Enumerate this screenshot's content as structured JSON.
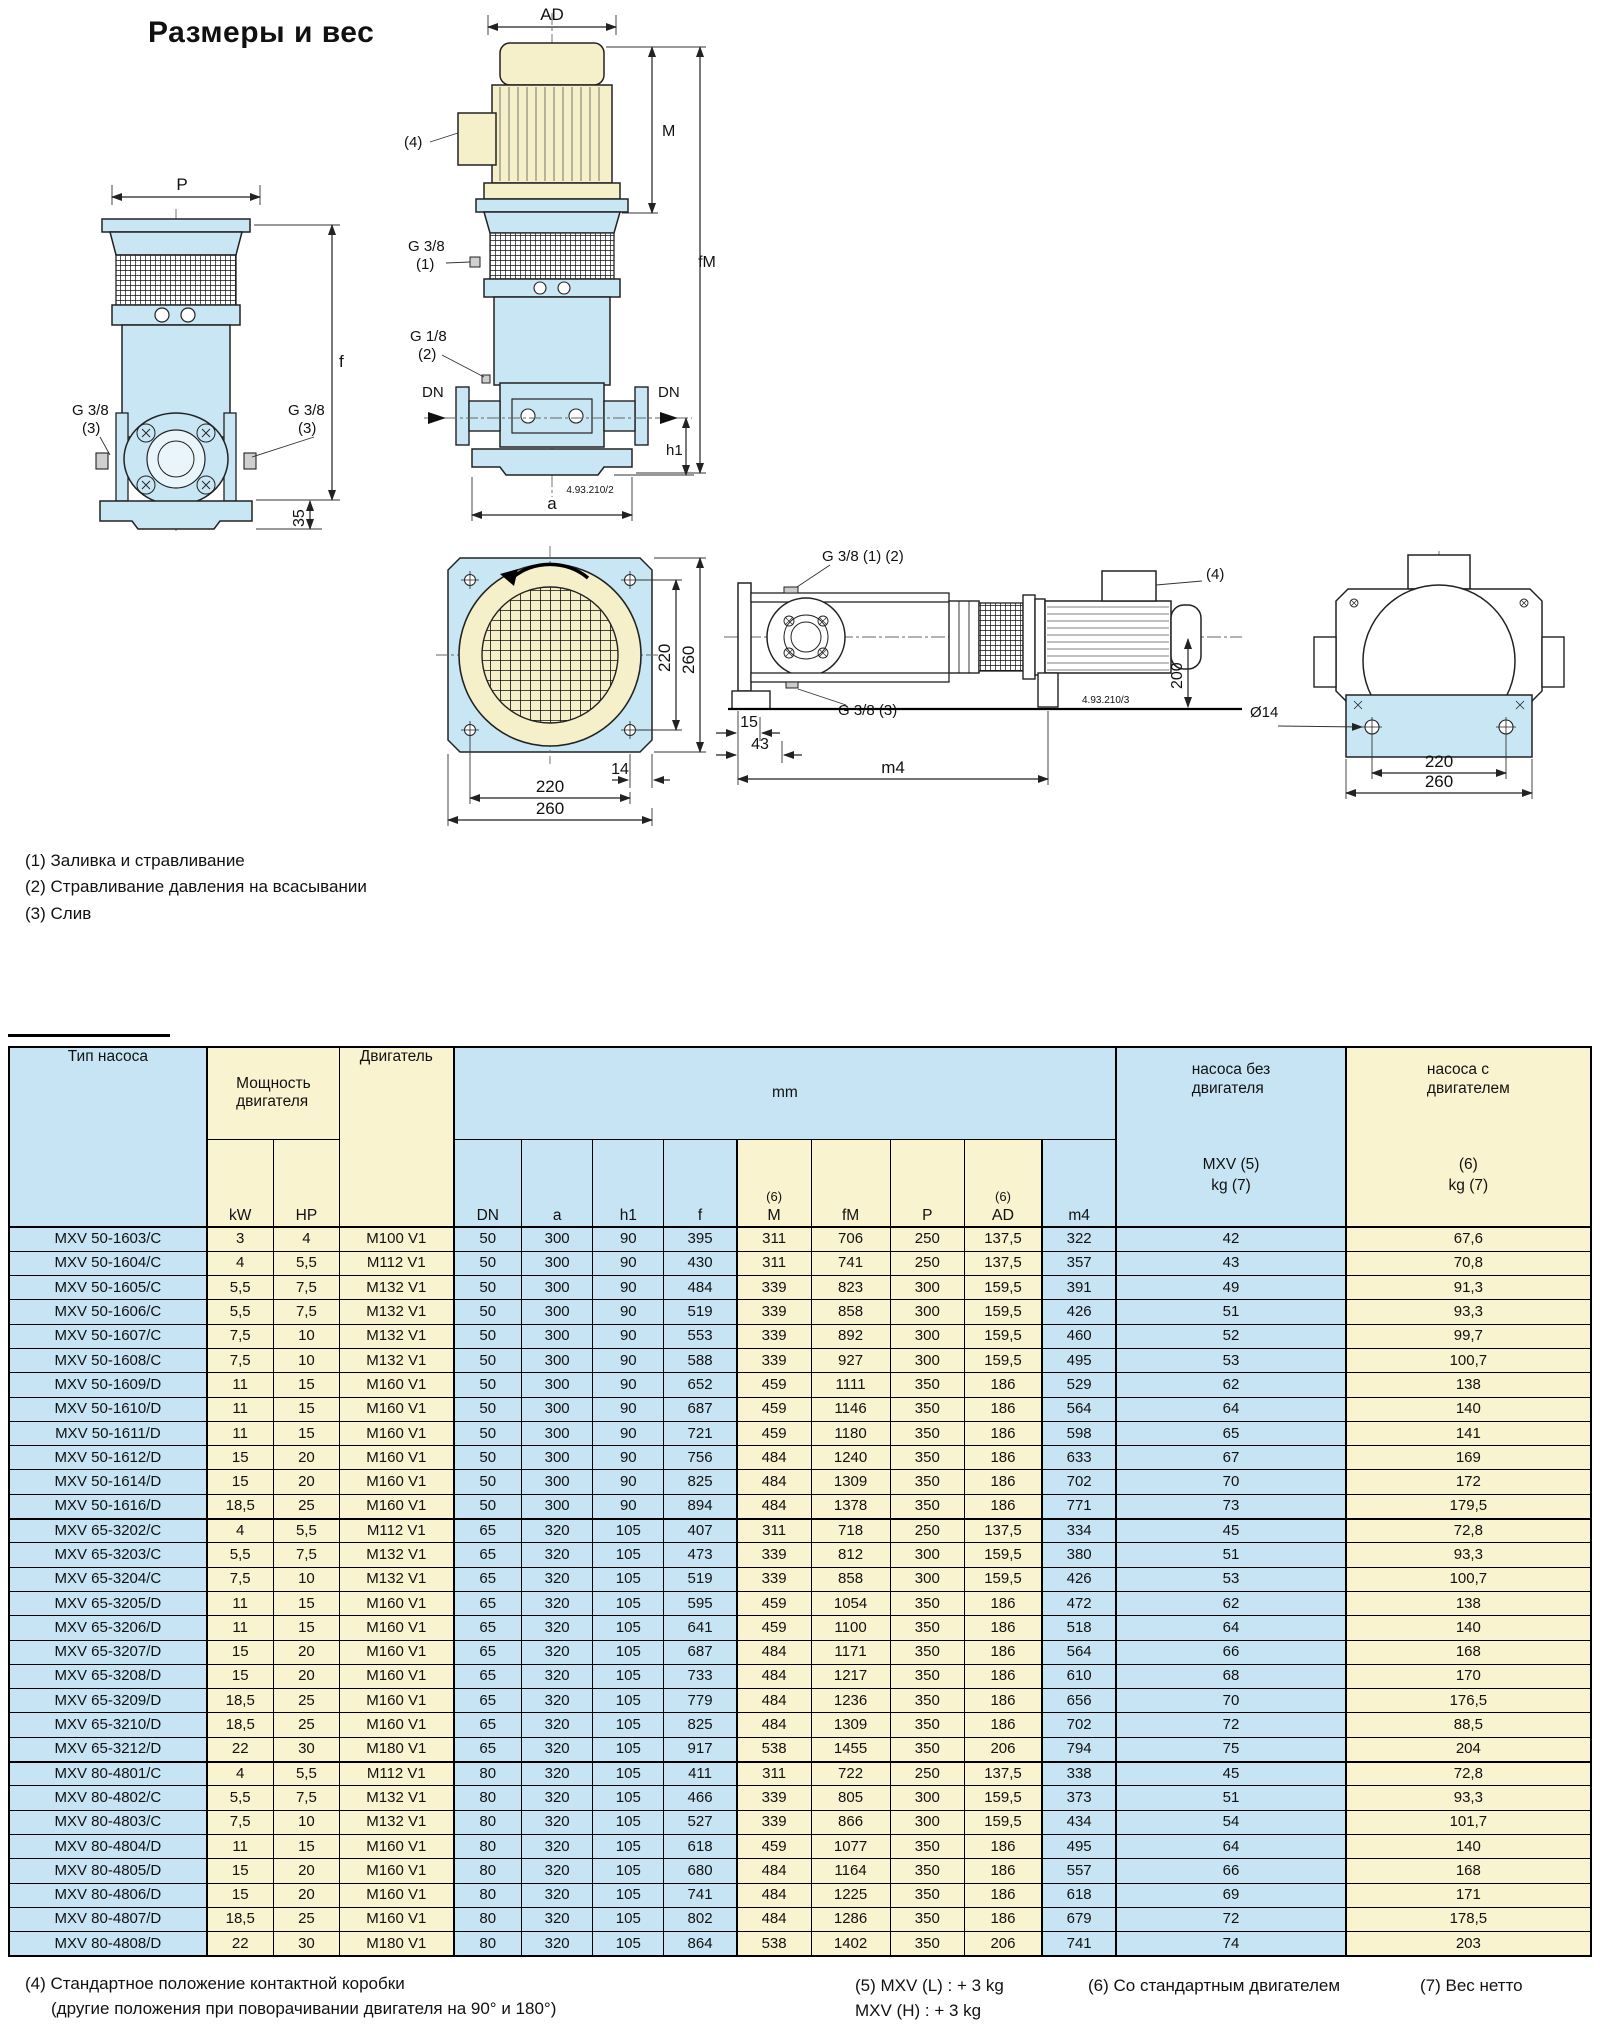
{
  "title": "Размеры и вес",
  "notes": {
    "n1": "(1) Заливка и стравливание",
    "n2": "(2) Стравливание давления на всасывании",
    "n3": "(3) Слив"
  },
  "labels": {
    "ad": "AD",
    "m": "M",
    "fm": "fM",
    "p": "P",
    "f": "f",
    "h1": "h1",
    "a": "a",
    "dn": "DN",
    "n35": "35",
    "g38": "G 3/8",
    "g18": "G 1/8",
    "r1": "(1)",
    "r2": "(2)",
    "r3": "(3)",
    "r4": "(4)",
    "code2": "4.93.210/2",
    "code3": "4.93.210/3",
    "g38_12": "G 3/8 (1) (2)",
    "g38_3": "G 3/8 (3)",
    "d14": "14",
    "d15": "15",
    "d43": "43",
    "d200": "200",
    "d220": "220",
    "d260": "260",
    "dia14": "Ø14",
    "m4": "m4"
  },
  "table": {
    "header": {
      "pump_type": "Тип насоса",
      "power_line1": "Мощность",
      "power_line2": "двигателя",
      "kw": "kW",
      "hp": "HP",
      "motor": "Двигатель",
      "mm": "mm",
      "sup6": "(6)",
      "d_dn": "DN",
      "d_a": "a",
      "d_h1": "h1",
      "d_f": "f",
      "d_m": "M",
      "d_fm": "fM",
      "d_p": "P",
      "d_ad": "AD",
      "d_m4": "m4",
      "wo_line1": "насоса без",
      "wo_line2": "двигателя",
      "wo_sub1": "MXV (5)",
      "wo_sub2": "kg (7)",
      "w_line1": "насоса с",
      "w_line2": "двигателем",
      "w_sub1": "(6)",
      "w_sub2": "kg (7)"
    },
    "groups": [
      {
        "rows": [
          [
            "MXV 50-1603/C",
            "3",
            "4",
            "M100 V1",
            "50",
            "300",
            "90",
            "395",
            "311",
            "706",
            "250",
            "137,5",
            "322",
            "42",
            "67,6"
          ],
          [
            "MXV 50-1604/C",
            "4",
            "5,5",
            "M112 V1",
            "50",
            "300",
            "90",
            "430",
            "311",
            "741",
            "250",
            "137,5",
            "357",
            "43",
            "70,8"
          ],
          [
            "MXV 50-1605/C",
            "5,5",
            "7,5",
            "M132 V1",
            "50",
            "300",
            "90",
            "484",
            "339",
            "823",
            "300",
            "159,5",
            "391",
            "49",
            "91,3"
          ],
          [
            "MXV 50-1606/C",
            "5,5",
            "7,5",
            "M132 V1",
            "50",
            "300",
            "90",
            "519",
            "339",
            "858",
            "300",
            "159,5",
            "426",
            "51",
            "93,3"
          ],
          [
            "MXV 50-1607/C",
            "7,5",
            "10",
            "M132 V1",
            "50",
            "300",
            "90",
            "553",
            "339",
            "892",
            "300",
            "159,5",
            "460",
            "52",
            "99,7"
          ],
          [
            "MXV 50-1608/C",
            "7,5",
            "10",
            "M132 V1",
            "50",
            "300",
            "90",
            "588",
            "339",
            "927",
            "300",
            "159,5",
            "495",
            "53",
            "100,7"
          ],
          [
            "MXV 50-1609/D",
            "11",
            "15",
            "M160 V1",
            "50",
            "300",
            "90",
            "652",
            "459",
            "1111",
            "350",
            "186",
            "529",
            "62",
            "138"
          ],
          [
            "MXV 50-1610/D",
            "11",
            "15",
            "M160 V1",
            "50",
            "300",
            "90",
            "687",
            "459",
            "1146",
            "350",
            "186",
            "564",
            "64",
            "140"
          ],
          [
            "MXV 50-1611/D",
            "11",
            "15",
            "M160 V1",
            "50",
            "300",
            "90",
            "721",
            "459",
            "1180",
            "350",
            "186",
            "598",
            "65",
            "141"
          ],
          [
            "MXV 50-1612/D",
            "15",
            "20",
            "M160 V1",
            "50",
            "300",
            "90",
            "756",
            "484",
            "1240",
            "350",
            "186",
            "633",
            "67",
            "169"
          ],
          [
            "MXV 50-1614/D",
            "15",
            "20",
            "M160 V1",
            "50",
            "300",
            "90",
            "825",
            "484",
            "1309",
            "350",
            "186",
            "702",
            "70",
            "172"
          ],
          [
            "MXV 50-1616/D",
            "18,5",
            "25",
            "M160 V1",
            "50",
            "300",
            "90",
            "894",
            "484",
            "1378",
            "350",
            "186",
            "771",
            "73",
            "179,5"
          ]
        ]
      },
      {
        "rows": [
          [
            "MXV 65-3202/C",
            "4",
            "5,5",
            "M112 V1",
            "65",
            "320",
            "105",
            "407",
            "311",
            "718",
            "250",
            "137,5",
            "334",
            "45",
            "72,8"
          ],
          [
            "MXV 65-3203/C",
            "5,5",
            "7,5",
            "M132 V1",
            "65",
            "320",
            "105",
            "473",
            "339",
            "812",
            "300",
            "159,5",
            "380",
            "51",
            "93,3"
          ],
          [
            "MXV 65-3204/C",
            "7,5",
            "10",
            "M132 V1",
            "65",
            "320",
            "105",
            "519",
            "339",
            "858",
            "300",
            "159,5",
            "426",
            "53",
            "100,7"
          ],
          [
            "MXV 65-3205/D",
            "11",
            "15",
            "M160 V1",
            "65",
            "320",
            "105",
            "595",
            "459",
            "1054",
            "350",
            "186",
            "472",
            "62",
            "138"
          ],
          [
            "MXV 65-3206/D",
            "11",
            "15",
            "M160 V1",
            "65",
            "320",
            "105",
            "641",
            "459",
            "1100",
            "350",
            "186",
            "518",
            "64",
            "140"
          ],
          [
            "MXV 65-3207/D",
            "15",
            "20",
            "M160 V1",
            "65",
            "320",
            "105",
            "687",
            "484",
            "1171",
            "350",
            "186",
            "564",
            "66",
            "168"
          ],
          [
            "MXV 65-3208/D",
            "15",
            "20",
            "M160 V1",
            "65",
            "320",
            "105",
            "733",
            "484",
            "1217",
            "350",
            "186",
            "610",
            "68",
            "170"
          ],
          [
            "MXV 65-3209/D",
            "18,5",
            "25",
            "M160 V1",
            "65",
            "320",
            "105",
            "779",
            "484",
            "1236",
            "350",
            "186",
            "656",
            "70",
            "176,5"
          ],
          [
            "MXV 65-3210/D",
            "18,5",
            "25",
            "M160 V1",
            "65",
            "320",
            "105",
            "825",
            "484",
            "1309",
            "350",
            "186",
            "702",
            "72",
            "88,5"
          ],
          [
            "MXV 65-3212/D",
            "22",
            "30",
            "M180 V1",
            "65",
            "320",
            "105",
            "917",
            "538",
            "1455",
            "350",
            "206",
            "794",
            "75",
            "204"
          ]
        ]
      },
      {
        "rows": [
          [
            "MXV 80-4801/C",
            "4",
            "5,5",
            "M112 V1",
            "80",
            "320",
            "105",
            "411",
            "311",
            "722",
            "250",
            "137,5",
            "338",
            "45",
            "72,8"
          ],
          [
            "MXV 80-4802/C",
            "5,5",
            "7,5",
            "M132 V1",
            "80",
            "320",
            "105",
            "466",
            "339",
            "805",
            "300",
            "159,5",
            "373",
            "51",
            "93,3"
          ],
          [
            "MXV 80-4803/C",
            "7,5",
            "10",
            "M132 V1",
            "80",
            "320",
            "105",
            "527",
            "339",
            "866",
            "300",
            "159,5",
            "434",
            "54",
            "101,7"
          ],
          [
            "MXV 80-4804/D",
            "11",
            "15",
            "M160 V1",
            "80",
            "320",
            "105",
            "618",
            "459",
            "1077",
            "350",
            "186",
            "495",
            "64",
            "140"
          ],
          [
            "MXV 80-4805/D",
            "15",
            "20",
            "M160 V1",
            "80",
            "320",
            "105",
            "680",
            "484",
            "1164",
            "350",
            "186",
            "557",
            "66",
            "168"
          ],
          [
            "MXV 80-4806/D",
            "15",
            "20",
            "M160 V1",
            "80",
            "320",
            "105",
            "741",
            "484",
            "1225",
            "350",
            "186",
            "618",
            "69",
            "171"
          ],
          [
            "MXV 80-4807/D",
            "18,5",
            "25",
            "M160 V1",
            "80",
            "320",
            "105",
            "802",
            "484",
            "1286",
            "350",
            "186",
            "679",
            "72",
            "178,5"
          ],
          [
            "MXV 80-4808/D",
            "22",
            "30",
            "M180 V1",
            "80",
            "320",
            "105",
            "864",
            "538",
            "1402",
            "350",
            "206",
            "741",
            "74",
            "203"
          ]
        ]
      }
    ]
  },
  "footnotes": {
    "f4a": "(4) Стандартное положение контактной коробки",
    "f4b": "(другие положения при поворачивании двигателя на 90° и 180°)",
    "f5a": "(5) MXV (L) : + 3 kg",
    "f5b": "MXV (H) : + 3 kg",
    "f6": "(6) Со стандартным двигателем",
    "f7": "(7) Вес нетто"
  }
}
